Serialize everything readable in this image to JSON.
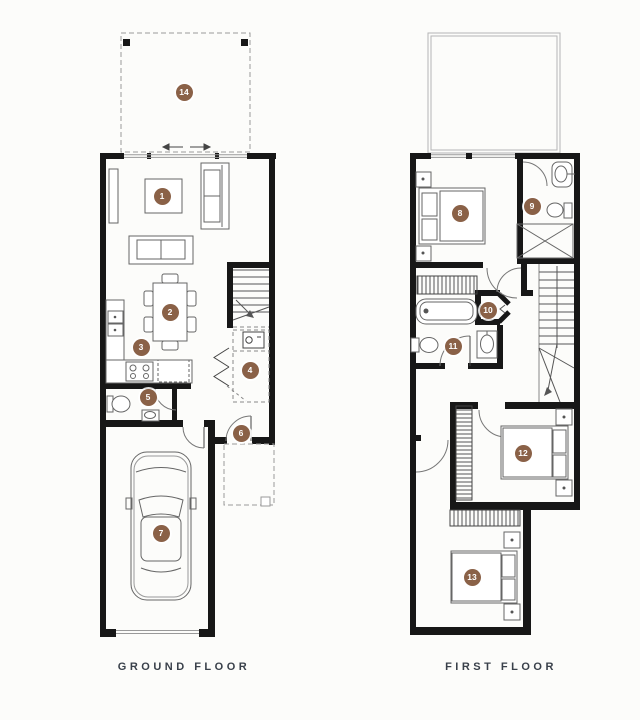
{
  "document": {
    "background_color": "#fcfcfa"
  },
  "palette": {
    "marker_color": "#8a6147",
    "wall_color": "#171717",
    "label_color": "#39404a"
  },
  "plans": {
    "ground": {
      "label": "GROUND FLOOR"
    },
    "first": {
      "label": "FIRST FLOOR"
    }
  },
  "markers": {
    "m1": "1",
    "m2": "2",
    "m3": "3",
    "m4": "4",
    "m5": "5",
    "m6": "6",
    "m7": "7",
    "m8": "8",
    "m9": "9",
    "m10": "10",
    "m11": "11",
    "m12": "12",
    "m13": "13",
    "m14": "14"
  }
}
